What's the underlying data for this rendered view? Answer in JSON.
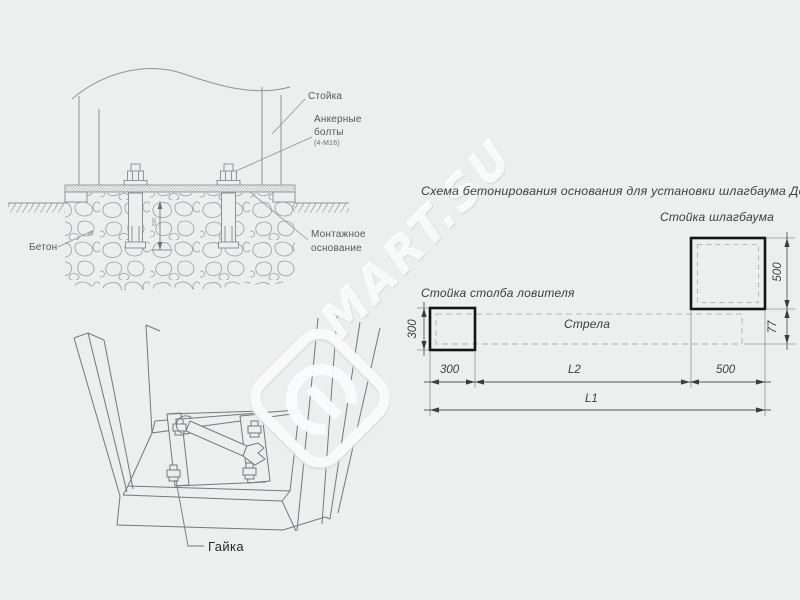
{
  "watermark": {
    "text": "MART.SU"
  },
  "section_view": {
    "post_label": "Стойка",
    "anchor_label_1": "Анкерные",
    "anchor_label_2": "болты",
    "anchor_spec": "(4-М16)",
    "base_label_1": "Монтажное",
    "base_label_2": "основание",
    "concrete_label": "Бетон",
    "depth_dim": "500"
  },
  "pit_view": {
    "nut_label": "Гайка"
  },
  "plan_view": {
    "title": "Схема бетонирования основания для установки шлагбаума ДорХан",
    "barrier_post_label": "Стойка шлагбаума",
    "catcher_post_label": "Стойка столба ловителя",
    "boom_label": "Стрела",
    "dims": {
      "catcher_w": "300",
      "catcher_h": "300",
      "post_w": "500",
      "post_h": "500",
      "boom_h": "77",
      "l2": "L2",
      "l1": "L1"
    }
  },
  "colors": {
    "background": "#edeeee",
    "thin_line": "#8e9497",
    "thick_line": "#141414",
    "dash_line": "#b4b8ba",
    "text": "#3b3e40"
  }
}
